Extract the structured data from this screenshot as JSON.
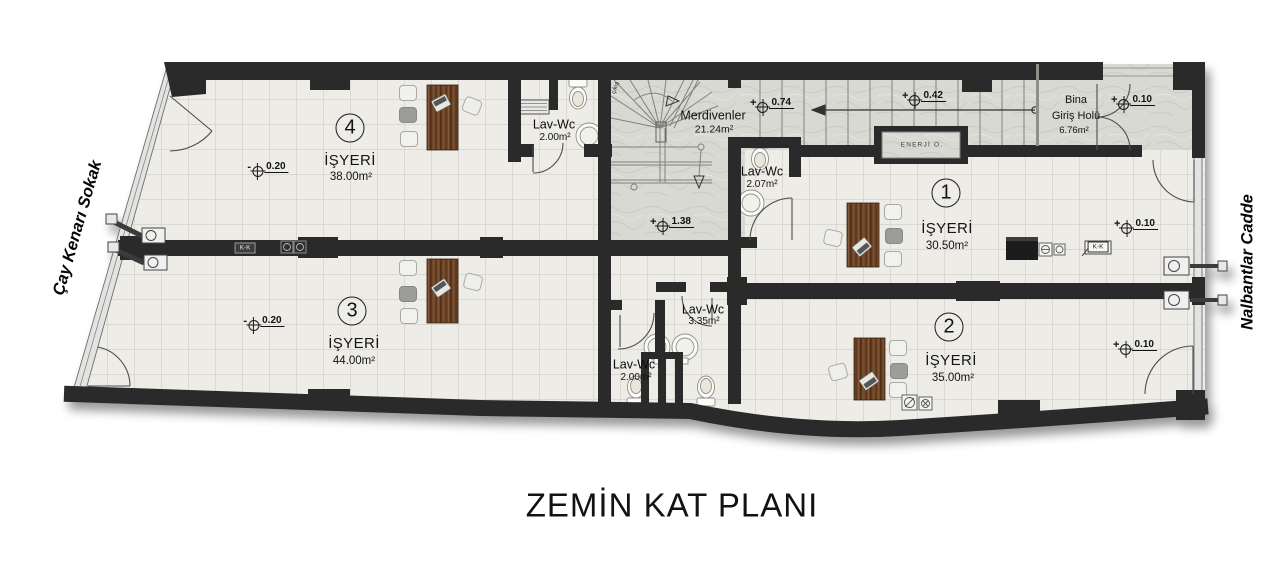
{
  "title": "ZEMİN KAT PLANI",
  "streets": {
    "left": "Çay Kenarı Sokak",
    "right": "Nalbantlar Cadde"
  },
  "rooms": [
    {
      "number": "1",
      "name": "İŞYERİ",
      "area": "30.50m²"
    },
    {
      "number": "2",
      "name": "İŞYERİ",
      "area": "35.00m²"
    },
    {
      "number": "3",
      "name": "İŞYERİ",
      "area": "44.00m²"
    },
    {
      "number": "4",
      "name": "İŞYERİ",
      "area": "38.00m²"
    }
  ],
  "wet_rooms": [
    {
      "name": "Lav-Wc",
      "area": "2.00m²"
    },
    {
      "name": "Lav-Wc",
      "area": "2.07m²"
    },
    {
      "name": "Lav-Wc",
      "area": "3.35m²"
    },
    {
      "name": "Lav-Wc",
      "area": "2.00m²"
    }
  ],
  "stairs": {
    "name": "Merdivenler",
    "area": "21.24m²",
    "exit_label": "çıkış"
  },
  "entrance_hall": {
    "line1": "Bina",
    "line2": "Giriş Holü",
    "area": "6.76m²"
  },
  "utility": {
    "label": "ENERJİ O."
  },
  "levels": [
    {
      "sign": "+",
      "value": "0.74"
    },
    {
      "sign": "+",
      "value": "0.42"
    },
    {
      "sign": "+",
      "value": "0.10"
    },
    {
      "sign": "+",
      "value": "1.38"
    },
    {
      "sign": "+",
      "value": "0.10"
    },
    {
      "sign": "+",
      "value": "0.10"
    },
    {
      "sign": "-",
      "value": "0.20"
    },
    {
      "sign": "-",
      "value": "0.20"
    }
  ],
  "section_marks": [
    {
      "label": "K-K"
    },
    {
      "label": "K-K"
    }
  ],
  "colors": {
    "wall": "#2b2b2b",
    "floor_tile": "#edece7",
    "stone": "#d8d9d2",
    "wood_desk": "#6e4627"
  }
}
